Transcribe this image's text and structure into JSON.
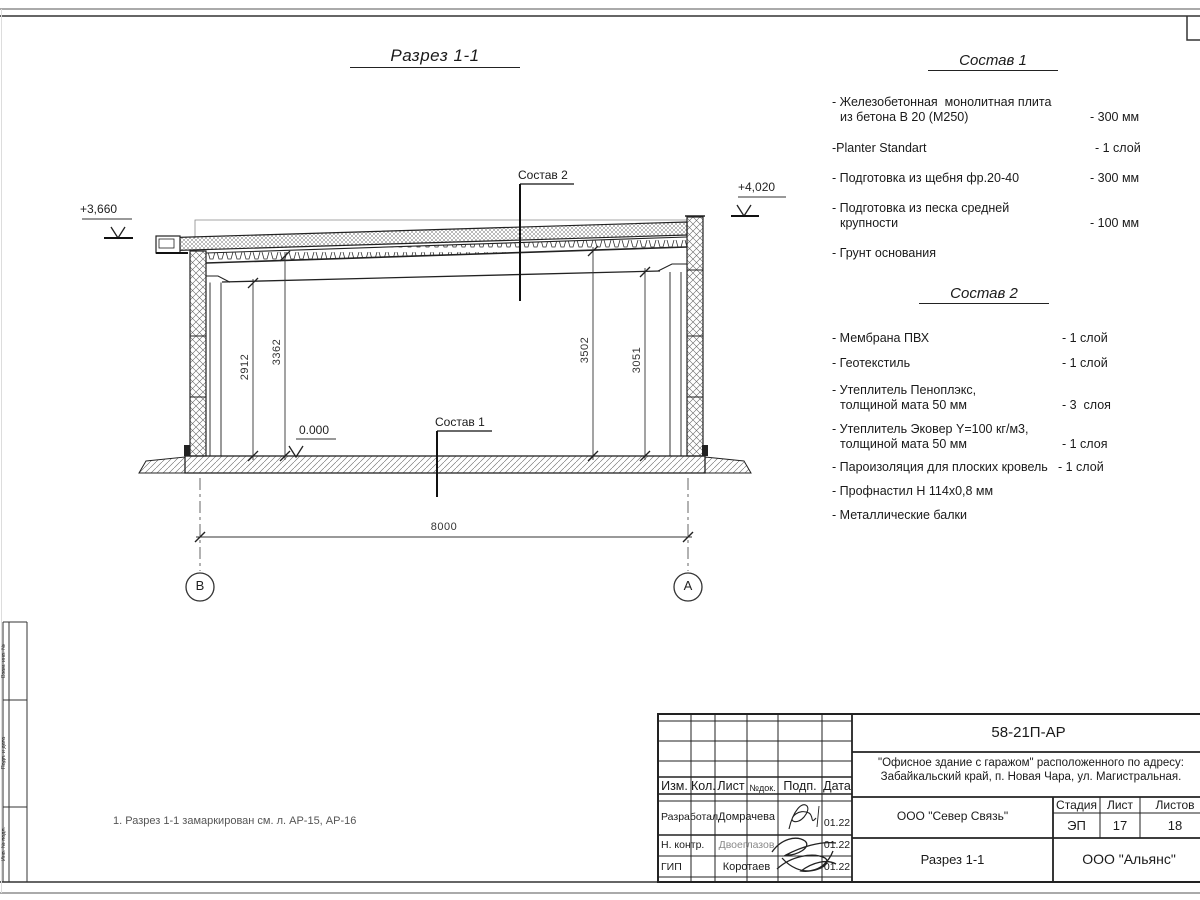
{
  "sheet": {
    "view_title": "Разрез 1-1",
    "note": "1. Разрез 1-1 замаркирован см. л. АР-15, АР-16"
  },
  "sostav1": {
    "title": "Состав 1",
    "items": [
      {
        "l1": "- Железобетонная  монолитная плита",
        "l2": "из бетона В 20 (М250)",
        "v": "- 300 мм"
      },
      {
        "l1": "-Planter Standart",
        "v": "- 1 слой"
      },
      {
        "l1": "- Подготовка из щебня фр.20-40",
        "v": "- 300 мм"
      },
      {
        "l1": "- Подготовка из песка средней",
        "l2": "крупности",
        "v": "- 100 мм"
      },
      {
        "l1": "- Грунт основания"
      }
    ]
  },
  "sostav2": {
    "title": "Состав 2",
    "items": [
      {
        "l1": "- Мембрана ПВХ",
        "v": "- 1 слой"
      },
      {
        "l1": "- Геотекстиль",
        "v": "- 1 слой"
      },
      {
        "l1": "- Утеплитель Пеноплэкс,",
        "l2": "толщиной мата 50 мм",
        "v": "- 3  слоя"
      },
      {
        "l1": "- Утеплитель Эковер Y=100 кг/м3,",
        "l2": "толщиной мата 50 мм",
        "v": "- 1 слоя"
      },
      {
        "l1": "- Пароизоляция для плоских кровель",
        "v": "- 1 слой"
      },
      {
        "l1": "- Профнастил Н 114х0,8 мм"
      },
      {
        "l1": "- Металлические балки"
      }
    ]
  },
  "drawing": {
    "callout_sostav2": "Состав 2",
    "callout_sostav1": "Состав 1",
    "elev_left": "+3,660",
    "elev_right": "+4,020",
    "elev_zero": "0.000",
    "dim_left_inner": "2912",
    "dim_left_outer": "3362",
    "dim_right_outer": "3502",
    "dim_right_inner": "3051",
    "dim_span": "8000",
    "axis_left": "В",
    "axis_right": "А"
  },
  "titleblock": {
    "doc_number": "58-21П-АР",
    "project_line1": "\"Офисное здание с гаражом\" расположенного по адресу:",
    "project_line2": "Забайкальский край, п. Новая Чара, ул. Магистральная.",
    "header_cols": [
      "Изм.",
      "Кол.",
      "Лист",
      "№док.",
      "Подп.",
      "Дата"
    ],
    "rows": [
      {
        "role": "Разработал",
        "name": "Домрачева",
        "date": "01.22"
      },
      {
        "role": "Н. контр.",
        "name": "Двоеглазов",
        "date": "01.22"
      },
      {
        "role": "ГИП",
        "name": "Коротаев",
        "date": "01.22"
      }
    ],
    "organization": "ООО \"Север Связь\"",
    "stage_label": "Стадия",
    "sheet_label": "Лист",
    "sheets_label": "Листов",
    "stage": "ЭП",
    "sheet_num": "17",
    "sheets_total": "18",
    "drawing_name": "Разрез 1-1",
    "contractor": "ООО \"Альянс\""
  },
  "side_stamp": {
    "labels": [
      "Взам. инв. №",
      "Подп. и дата",
      "Инв. № подл."
    ]
  }
}
